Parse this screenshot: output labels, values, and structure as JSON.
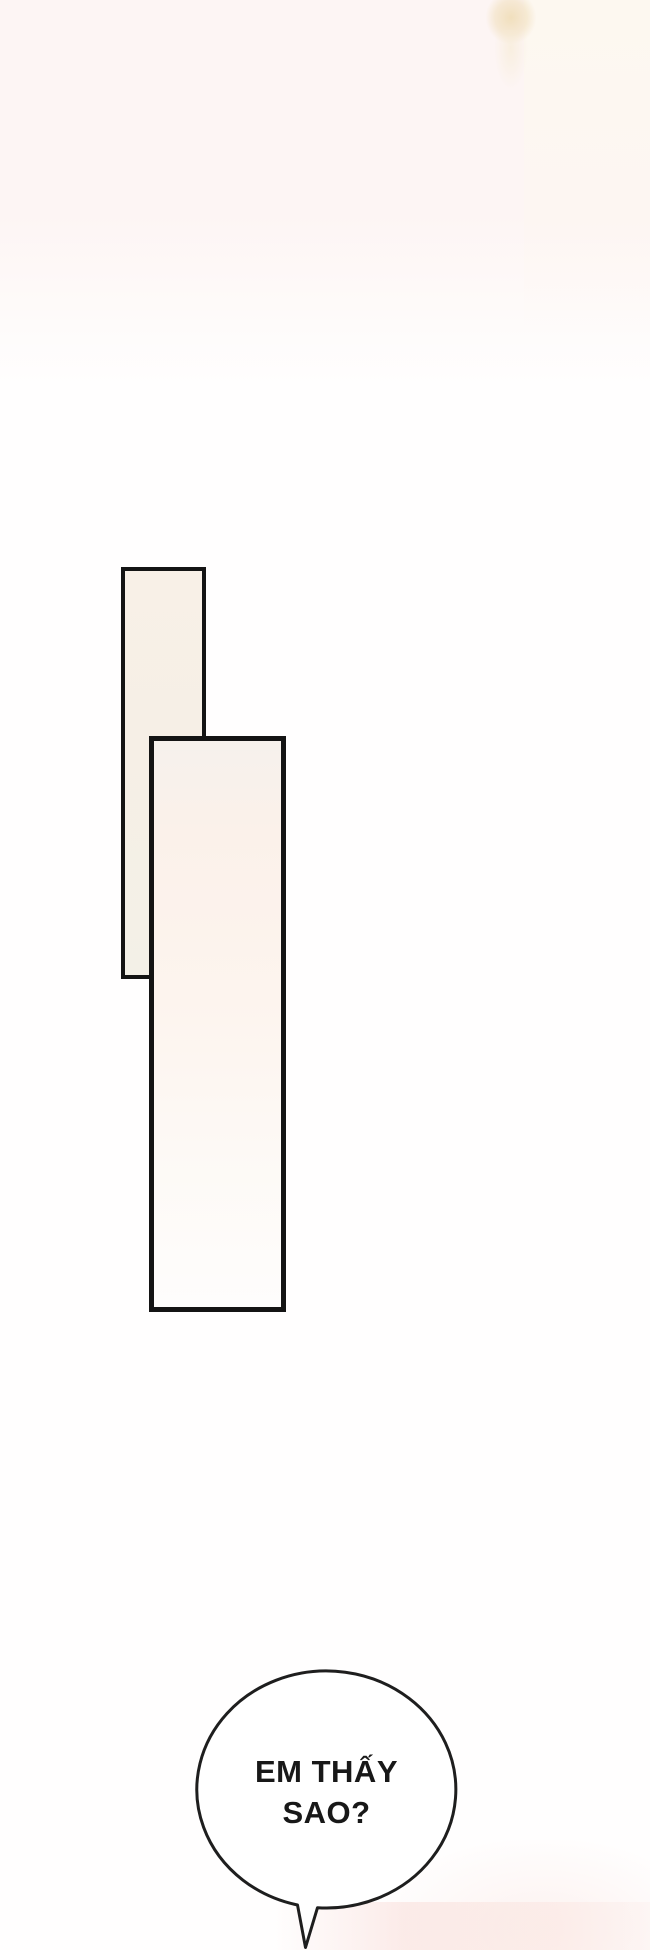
{
  "page": {
    "kind": "comic-page",
    "speech_bubble": {
      "line1": "EM THẤY",
      "line2": "SAO?"
    },
    "colors": {
      "ink": "#141414",
      "bubble_stroke": "#1e1e1e",
      "bubble_fill": "#ffffff",
      "paper_white": "#fffefe",
      "top_pink_tint": "#fdf5f4",
      "top_right_warm": "#fdf8f0",
      "beige_smudge": "#f0deba",
      "panel_back_fill": "#f6efe6",
      "panel_front_fill": "#fcf3ec",
      "bottom_pink_tint": "#fae5e2"
    }
  }
}
